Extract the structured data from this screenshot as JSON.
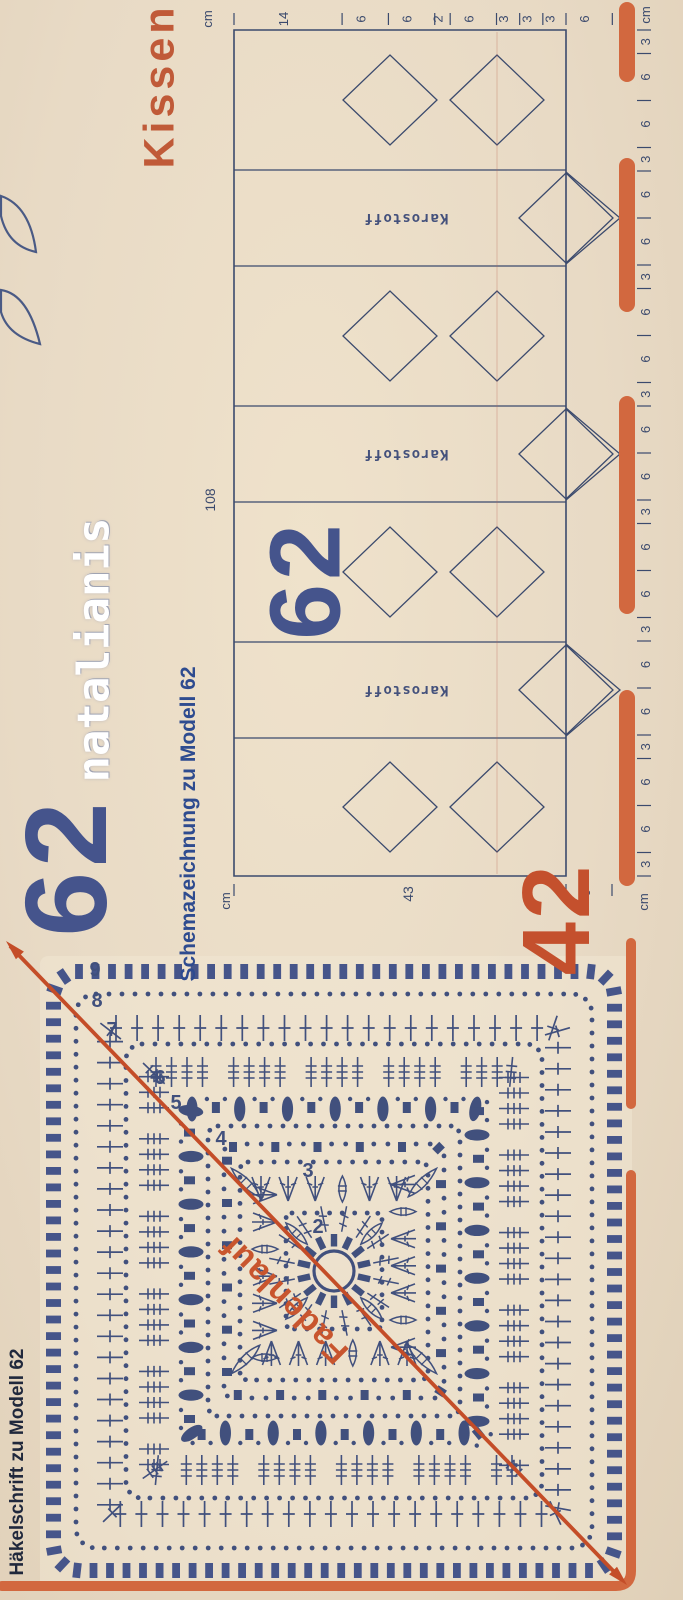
{
  "colors": {
    "background": "#e8dac5",
    "symbol_blue": "#41507d",
    "schematic_blue": "#3b4a6d",
    "caption_blue": "#2e4b8f",
    "heading_navy": "#20283c",
    "model_blue": "#45548c",
    "accent_orange": "#d2683f",
    "grain_red": "#c44d28",
    "piece_orange": "#c4502d",
    "watermark_white": "#ffffff"
  },
  "page": {
    "title": "Kissen",
    "watermark": "natalianis",
    "model_number": "62"
  },
  "schematic": {
    "caption": "Schemazeichnung zu Modell 62",
    "model_number": "62",
    "piece_number": "42",
    "fabric_labels": [
      "Karostoff",
      "Karostoff",
      "Karostoff"
    ],
    "unit": "cm",
    "length_total": "108",
    "width_total": "43",
    "edge_depth": "6",
    "top_ruler_segments": [
      "14",
      "6",
      "6",
      "2",
      "6",
      "3",
      "3",
      "3",
      "6"
    ],
    "right_ruler_segments": [
      "3",
      "6",
      "6",
      "3",
      "6",
      "6",
      "3",
      "6",
      "6",
      "3",
      "6",
      "6",
      "3",
      "6",
      "6",
      "3",
      "6",
      "6",
      "3",
      "6",
      "6",
      "3"
    ]
  },
  "chart": {
    "caption": "Häkelschrift zu Modell 62",
    "grain_label": "Fadenlauf",
    "round_numbers": [
      "2",
      "3",
      "4",
      "5",
      "6",
      "7",
      "8",
      "9"
    ]
  }
}
